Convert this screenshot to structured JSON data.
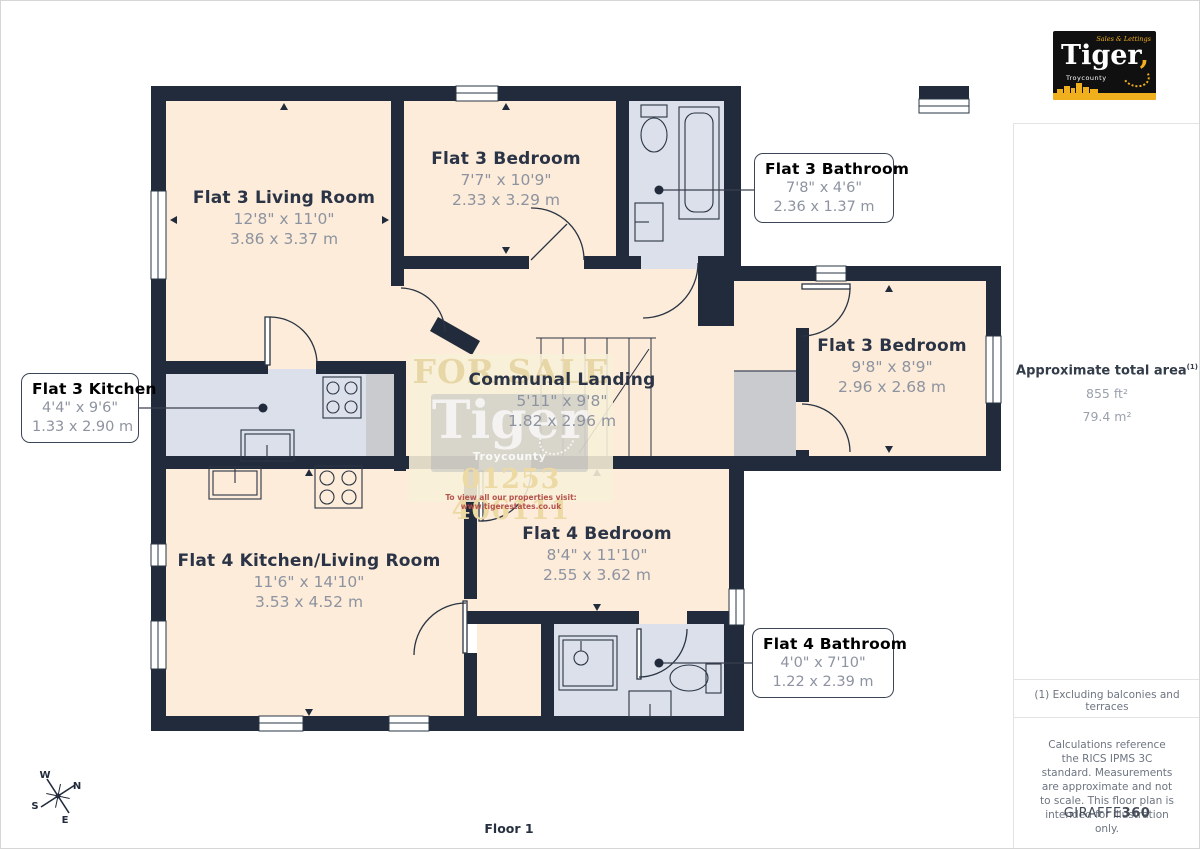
{
  "page": {
    "floor_label": "Floor 1"
  },
  "branding": {
    "logo_name": "Tiger",
    "logo_tagline": "Sales & Lettings",
    "logo_subtitle": "Troycounty",
    "giraffe_normal": "GIRAFFE",
    "giraffe_bold": "360"
  },
  "sidebar": {
    "area_title": "Approximate total area",
    "area_sup": "(1)",
    "area_ft": "855 ft²",
    "area_m": "79.4 m²",
    "note1": "(1) Excluding balconies and terraces",
    "note2": "Calculations reference the RICS IPMS 3C standard. Measurements are approximate and not to scale. This floor plan is intended for illustration only."
  },
  "rooms": [
    {
      "name": "Flat 3 Living Room",
      "imperial": "12'8\" x 11'0\"",
      "metric": "3.86 x 3.37 m"
    },
    {
      "name": "Flat 3 Bedroom",
      "imperial": "7'7\" x 10'9\"",
      "metric": "2.33 x 3.29 m"
    },
    {
      "name": "Flat 3 Bathroom",
      "imperial": "7'8\" x 4'6\"",
      "metric": "2.36 x 1.37 m"
    },
    {
      "name": "Flat 3 Kitchen",
      "imperial": "4'4\" x 9'6\"",
      "metric": "1.33 x 2.90 m"
    },
    {
      "name": "Flat 3 Bedroom",
      "imperial": "9'8\" x 8'9\"",
      "metric": "2.96 x 2.68 m"
    },
    {
      "name": "Communal Landing",
      "imperial": "5'11\" x 9'8\"",
      "metric": "1.82 x 2.96 m"
    },
    {
      "name": "Flat 4 Kitchen/Living Room",
      "imperial": "11'6\" x 14'10\"",
      "metric": "3.53 x 4.52 m"
    },
    {
      "name": "Flat 4 Bedroom",
      "imperial": "8'4\" x 11'10\"",
      "metric": "2.55 x 3.62 m"
    },
    {
      "name": "Flat 4 Bathroom",
      "imperial": "4'0\" x 7'10\"",
      "metric": "1.22 x 2.39 m"
    }
  ],
  "watermark": {
    "line1": "FOR SALE",
    "logo": "Tiger",
    "logo_sub": "Troycounty",
    "phone": "01253 406111",
    "tagline": "To view all our properties visit: www.tigerestates.co.uk"
  },
  "compass": {
    "n": "N",
    "s": "S",
    "e": "E",
    "w": "W"
  },
  "colors": {
    "wall": "#212b3b",
    "room_cream": "#fcecd9",
    "room_wet": "#dbe0eb",
    "room_gray": "#c9cbce",
    "brand_gold": "#f0af1d",
    "dim_text": "#8d93a0"
  }
}
